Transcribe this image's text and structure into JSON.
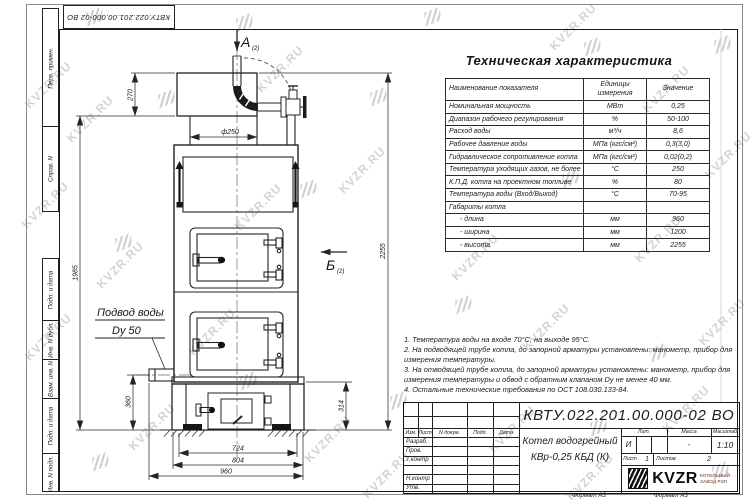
{
  "watermark": {
    "text": "KVZR.RU"
  },
  "corner_stamp": {
    "doc_number": "КВТУ.022.201.00.000-02  ВО"
  },
  "margin": {
    "top_strip": [
      "Перв. примен.",
      "Справ. N"
    ],
    "bottom_strip": [
      "Подп. и дата",
      "Инв. N дубл.",
      "Взам. инв. N",
      "Подп. и дата",
      "Инв. N подл."
    ]
  },
  "labels": {
    "a": "А",
    "a_sub": "(2)",
    "b": "Б",
    "b_sub": "(2)",
    "water1": "Подвод воды",
    "water2": "Dy 50"
  },
  "dims": {
    "phi250": "ф250",
    "d270": "270",
    "d1985": "1985",
    "d2255": "2255",
    "d360": "360",
    "d314": "314",
    "d724": "724",
    "d804": "804",
    "d960": "960"
  },
  "table": {
    "title": "Техническая характеристика",
    "headers": [
      "Наименование показателя",
      "Единицы измерения",
      "Значение"
    ],
    "rows": [
      [
        "Номинальная мощность",
        "МВт",
        "0,25"
      ],
      [
        "Диапазон рабочего регулирования",
        "%",
        "50-100"
      ],
      [
        "Расход воды",
        "м³/ч",
        "8,6"
      ],
      [
        "Рабочее давление воды",
        "МПа (кгс/см²)",
        "0,3(3,0)"
      ],
      [
        "Гидравлическое сопротивление котла",
        "МПа (кгс/см²)",
        "0,02(0,2)"
      ],
      [
        "Температура уходящих газов, не более",
        "°С",
        "250"
      ],
      [
        "К.П.Д. котла на проектном топливе",
        "%",
        "80"
      ],
      [
        "Температура воды (Вход/Выход)",
        "°С",
        "70-95"
      ],
      [
        "Габариты котла",
        "",
        ""
      ],
      [
        "- длина",
        "мм",
        "960"
      ],
      [
        "- ширина",
        "мм",
        "1200"
      ],
      [
        "- высота",
        "мм",
        "2255"
      ]
    ]
  },
  "notes": [
    "1.  Температура воды на входе  70°С, на выходе  95°С.",
    "2.  На подводящей трубе котла, до запорной арматуры установлены:  манометр, прибор для измерения температуры.",
    "3.  На отводящей трубе котла, до запорной арматуры установлены:  манометр, прибор для измерения температуры и обвод с обратным клапаном  Dу не менее 40 мм.",
    "4.  Остальные технические требования по ОСТ  108.030.133-84."
  ],
  "title_block": {
    "doc_number": "КВТУ.022.201.00.000-02  ВО",
    "columns": [
      "Изм.",
      "Лист",
      "N докум.",
      "Подп.",
      "Дата"
    ],
    "role_rows": [
      "Разраб.",
      "Пров.",
      "Т.контр",
      "",
      "Н.контр",
      "Утв."
    ],
    "product_line1": "Котел водогрейный",
    "product_line2": "КВр-0,25  КБД  (К)",
    "lit_header": "Лит.",
    "lit_value": "И",
    "mass_header": "Масса",
    "mass_value": "-",
    "scale_header": "Масштаб",
    "scale_value": "1:10",
    "sheet_label": "Лист",
    "sheet_value": "1",
    "sheets_label": "Листов",
    "sheets_value": "2",
    "logo_text": "KVZR",
    "logo_sub1": "КОТЕЛЬНЫЙ",
    "logo_sub2": "ЗАВОД РЭП",
    "format_left": "Формат А3",
    "format_right": "Формат А3"
  }
}
